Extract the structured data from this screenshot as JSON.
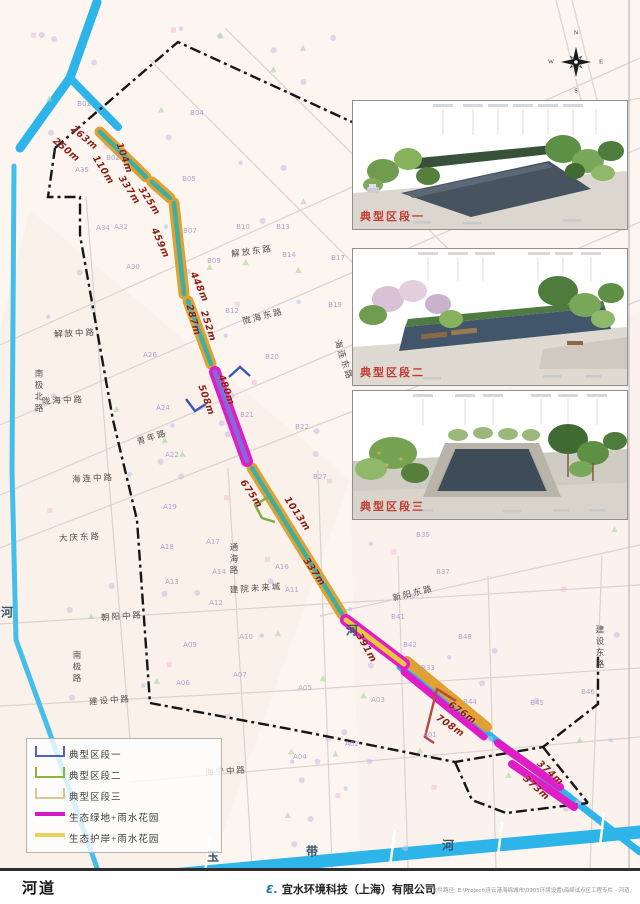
{
  "map": {
    "segments": [
      {
        "label": "263m",
        "x": 84,
        "y": 138,
        "rot": 40
      },
      {
        "label": "250m",
        "x": 66,
        "y": 150,
        "rot": 40
      },
      {
        "label": "110m",
        "x": 103,
        "y": 170,
        "rot": 58
      },
      {
        "label": "104m",
        "x": 124,
        "y": 158,
        "rot": 70
      },
      {
        "label": "337m",
        "x": 129,
        "y": 190,
        "rot": 57
      },
      {
        "label": "325m",
        "x": 149,
        "y": 201,
        "rot": 57
      },
      {
        "label": "459m",
        "x": 160,
        "y": 243,
        "rot": 66
      },
      {
        "label": "448m",
        "x": 199,
        "y": 287,
        "rot": 66
      },
      {
        "label": "287m",
        "x": 193,
        "y": 320,
        "rot": 74
      },
      {
        "label": "252m",
        "x": 208,
        "y": 326,
        "rot": 72
      },
      {
        "label": "480m",
        "x": 226,
        "y": 390,
        "rot": 70
      },
      {
        "label": "508m",
        "x": 206,
        "y": 400,
        "rot": 70
      },
      {
        "label": "675m",
        "x": 251,
        "y": 494,
        "rot": 56
      },
      {
        "label": "1013m",
        "x": 297,
        "y": 514,
        "rot": 56
      },
      {
        "label": "337m",
        "x": 314,
        "y": 572,
        "rot": 56
      },
      {
        "label": "391m",
        "x": 366,
        "y": 648,
        "rot": 60
      },
      {
        "label": "676m",
        "x": 462,
        "y": 713,
        "rot": 34
      },
      {
        "label": "708m",
        "x": 450,
        "y": 726,
        "rot": 34
      },
      {
        "label": "374m",
        "x": 550,
        "y": 773,
        "rot": 42
      },
      {
        "label": "373m",
        "x": 536,
        "y": 788,
        "rot": 42
      }
    ],
    "roads": [
      {
        "name": "解放中路",
        "x": 75,
        "y": 333,
        "rot": -3,
        "v": false
      },
      {
        "name": "解放东路",
        "x": 252,
        "y": 251,
        "rot": -8,
        "v": false
      },
      {
        "name": "陇海中路",
        "x": 63,
        "y": 400,
        "rot": -3,
        "v": false
      },
      {
        "name": "陇海东路",
        "x": 263,
        "y": 316,
        "rot": -14,
        "v": false
      },
      {
        "name": "海连中路",
        "x": 93,
        "y": 478,
        "rot": -3,
        "v": false
      },
      {
        "name": "海连东路",
        "x": 344,
        "y": 360,
        "rot": 72,
        "v": false
      },
      {
        "name": "南极北路",
        "x": 39,
        "y": 392,
        "rot": 0,
        "v": true
      },
      {
        "name": "青年路",
        "x": 152,
        "y": 437,
        "rot": -18,
        "v": false
      },
      {
        "name": "大庆东路",
        "x": 80,
        "y": 537,
        "rot": -3,
        "v": false
      },
      {
        "name": "通海路",
        "x": 234,
        "y": 560,
        "rot": 0,
        "v": true
      },
      {
        "name": "建院未来城",
        "x": 256,
        "y": 588,
        "rot": -4,
        "v": false
      },
      {
        "name": "朝阳中路",
        "x": 122,
        "y": 616,
        "rot": -4,
        "v": false
      },
      {
        "name": "南极路",
        "x": 77,
        "y": 668,
        "rot": 0,
        "v": true
      },
      {
        "name": "建设中路",
        "x": 110,
        "y": 700,
        "rot": -4,
        "v": false
      },
      {
        "name": "海宁中路",
        "x": 226,
        "y": 771,
        "rot": -4,
        "v": false
      },
      {
        "name": "新阳东路",
        "x": 413,
        "y": 593,
        "rot": -14,
        "v": false
      },
      {
        "name": "建设东路",
        "x": 600,
        "y": 648,
        "rot": 0,
        "v": true
      }
    ],
    "river_labels": [
      {
        "ch": "玉",
        "x": 213,
        "y": 856
      },
      {
        "ch": "带",
        "x": 312,
        "y": 851
      },
      {
        "ch": "河",
        "x": 448,
        "y": 845
      },
      {
        "ch": "河",
        "x": 352,
        "y": 630
      },
      {
        "ch": "河",
        "x": 7,
        "y": 612
      }
    ],
    "parcels": [
      {
        "id": "B01",
        "x": 84,
        "y": 104
      },
      {
        "id": "B04",
        "x": 197,
        "y": 113
      },
      {
        "id": "B02",
        "x": 113,
        "y": 158
      },
      {
        "id": "B05",
        "x": 189,
        "y": 179
      },
      {
        "id": "B07",
        "x": 190,
        "y": 231
      },
      {
        "id": "B09",
        "x": 214,
        "y": 261
      },
      {
        "id": "B10",
        "x": 243,
        "y": 227
      },
      {
        "id": "B13",
        "x": 283,
        "y": 227
      },
      {
        "id": "B14",
        "x": 289,
        "y": 255
      },
      {
        "id": "B17",
        "x": 338,
        "y": 258
      },
      {
        "id": "B12",
        "x": 232,
        "y": 311
      },
      {
        "id": "B19",
        "x": 335,
        "y": 305
      },
      {
        "id": "B20",
        "x": 272,
        "y": 357
      },
      {
        "id": "B21",
        "x": 247,
        "y": 415
      },
      {
        "id": "B22",
        "x": 302,
        "y": 427
      },
      {
        "id": "B27",
        "x": 320,
        "y": 477
      },
      {
        "id": "B35",
        "x": 423,
        "y": 535
      },
      {
        "id": "B37",
        "x": 443,
        "y": 572
      },
      {
        "id": "B41",
        "x": 398,
        "y": 617
      },
      {
        "id": "B42",
        "x": 410,
        "y": 645
      },
      {
        "id": "B48",
        "x": 465,
        "y": 637
      },
      {
        "id": "B33",
        "x": 428,
        "y": 668
      },
      {
        "id": "B44",
        "x": 470,
        "y": 702
      },
      {
        "id": "B45",
        "x": 537,
        "y": 703
      },
      {
        "id": "B46",
        "x": 588,
        "y": 692
      },
      {
        "id": "A35",
        "x": 82,
        "y": 170
      },
      {
        "id": "A34",
        "x": 103,
        "y": 228
      },
      {
        "id": "A32",
        "x": 121,
        "y": 227
      },
      {
        "id": "A30",
        "x": 133,
        "y": 267
      },
      {
        "id": "A26",
        "x": 150,
        "y": 355
      },
      {
        "id": "A24",
        "x": 163,
        "y": 408
      },
      {
        "id": "A22",
        "x": 172,
        "y": 455
      },
      {
        "id": "A19",
        "x": 170,
        "y": 507
      },
      {
        "id": "A18",
        "x": 167,
        "y": 547
      },
      {
        "id": "A17",
        "x": 213,
        "y": 542
      },
      {
        "id": "A13",
        "x": 172,
        "y": 582
      },
      {
        "id": "A14",
        "x": 219,
        "y": 572
      },
      {
        "id": "A12",
        "x": 216,
        "y": 603
      },
      {
        "id": "A16",
        "x": 282,
        "y": 567
      },
      {
        "id": "A11",
        "x": 292,
        "y": 590
      },
      {
        "id": "A09",
        "x": 190,
        "y": 645
      },
      {
        "id": "A10",
        "x": 246,
        "y": 637
      },
      {
        "id": "A07",
        "x": 240,
        "y": 675
      },
      {
        "id": "A06",
        "x": 183,
        "y": 683
      },
      {
        "id": "A05",
        "x": 305,
        "y": 688
      },
      {
        "id": "A03",
        "x": 378,
        "y": 700
      },
      {
        "id": "A02",
        "x": 352,
        "y": 744
      },
      {
        "id": "A04",
        "x": 300,
        "y": 757
      },
      {
        "id": "A01",
        "x": 430,
        "y": 735
      }
    ]
  },
  "insets": [
    {
      "label": "典型区段一"
    },
    {
      "label": "典型区段二"
    },
    {
      "label": "典型区段三"
    }
  ],
  "legend": {
    "items": [
      {
        "label": "典型区段一",
        "type": "bracket",
        "color": "#4a63c8"
      },
      {
        "label": "典型区段二",
        "type": "bracket",
        "color": "#8ab43e"
      },
      {
        "label": "典型区段三",
        "type": "bracket",
        "color": "#d8c494"
      },
      {
        "label": "生态绿地+雨水花园",
        "type": "line",
        "color": "#d318c4"
      },
      {
        "label": "生态护岸+雨水花园",
        "type": "line",
        "color": "#ecd05c"
      }
    ]
  },
  "compass": {
    "n": "N",
    "e": "E",
    "s": "S",
    "w": "W"
  },
  "footer": {
    "map_label": "河道",
    "logo": "Ɛ.",
    "company": "宜水环境科技（上海）有限公司",
    "file_path": "文件路径: E:\\Project\\连云港海绵城市\\0905环境设置\\海绵试点区工程专栏 - 河道.mxd"
  },
  "colors": {
    "corridor_orange": "#dfa133",
    "corridor_teal": "#3fae9f",
    "corridor_magenta": "#df1cc6",
    "corridor_purple": "#8468d8",
    "river_cyan": "#2db4e8",
    "distance_label": "#8f1f14"
  }
}
